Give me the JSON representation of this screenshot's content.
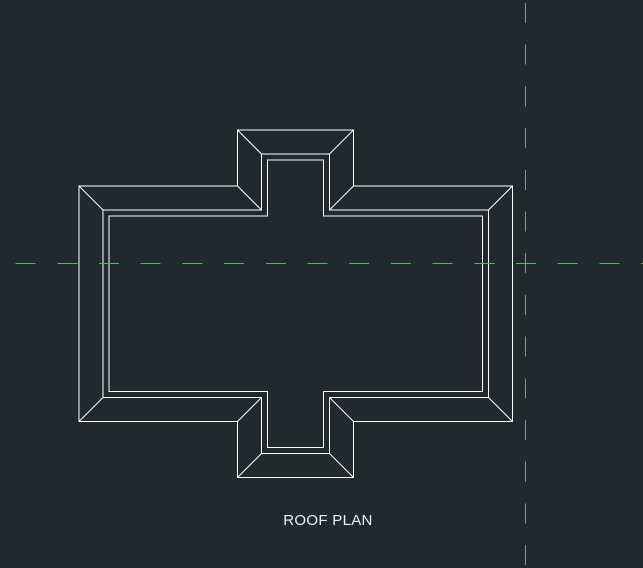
{
  "viewport": {
    "width": 643,
    "height": 568,
    "background_color": "#212830"
  },
  "drawing": {
    "title": "ROOF PLAN",
    "title_color": "#efefef",
    "title_position": {
      "x": 328,
      "y": 513
    },
    "line_color": "#ffffff",
    "centerline_color": "#4abf55",
    "geometry": {
      "outer_cross": {
        "x1": 79,
        "y1": 186,
        "x2": 512.5,
        "y2": 421.5,
        "bump_x1": 237.5,
        "bump_x2": 353.5,
        "bump_top_y": 130,
        "bump_bottom_y": 477.5
      },
      "middle_offset": 24,
      "inner_offset": 30,
      "centerlines": {
        "horizontal_y": 263.5,
        "vertical_x": 525.5,
        "dash_length": 20,
        "gap_length": 21.7,
        "horizontal_phase": 15.6,
        "vertical_phase": 3
      }
    }
  }
}
